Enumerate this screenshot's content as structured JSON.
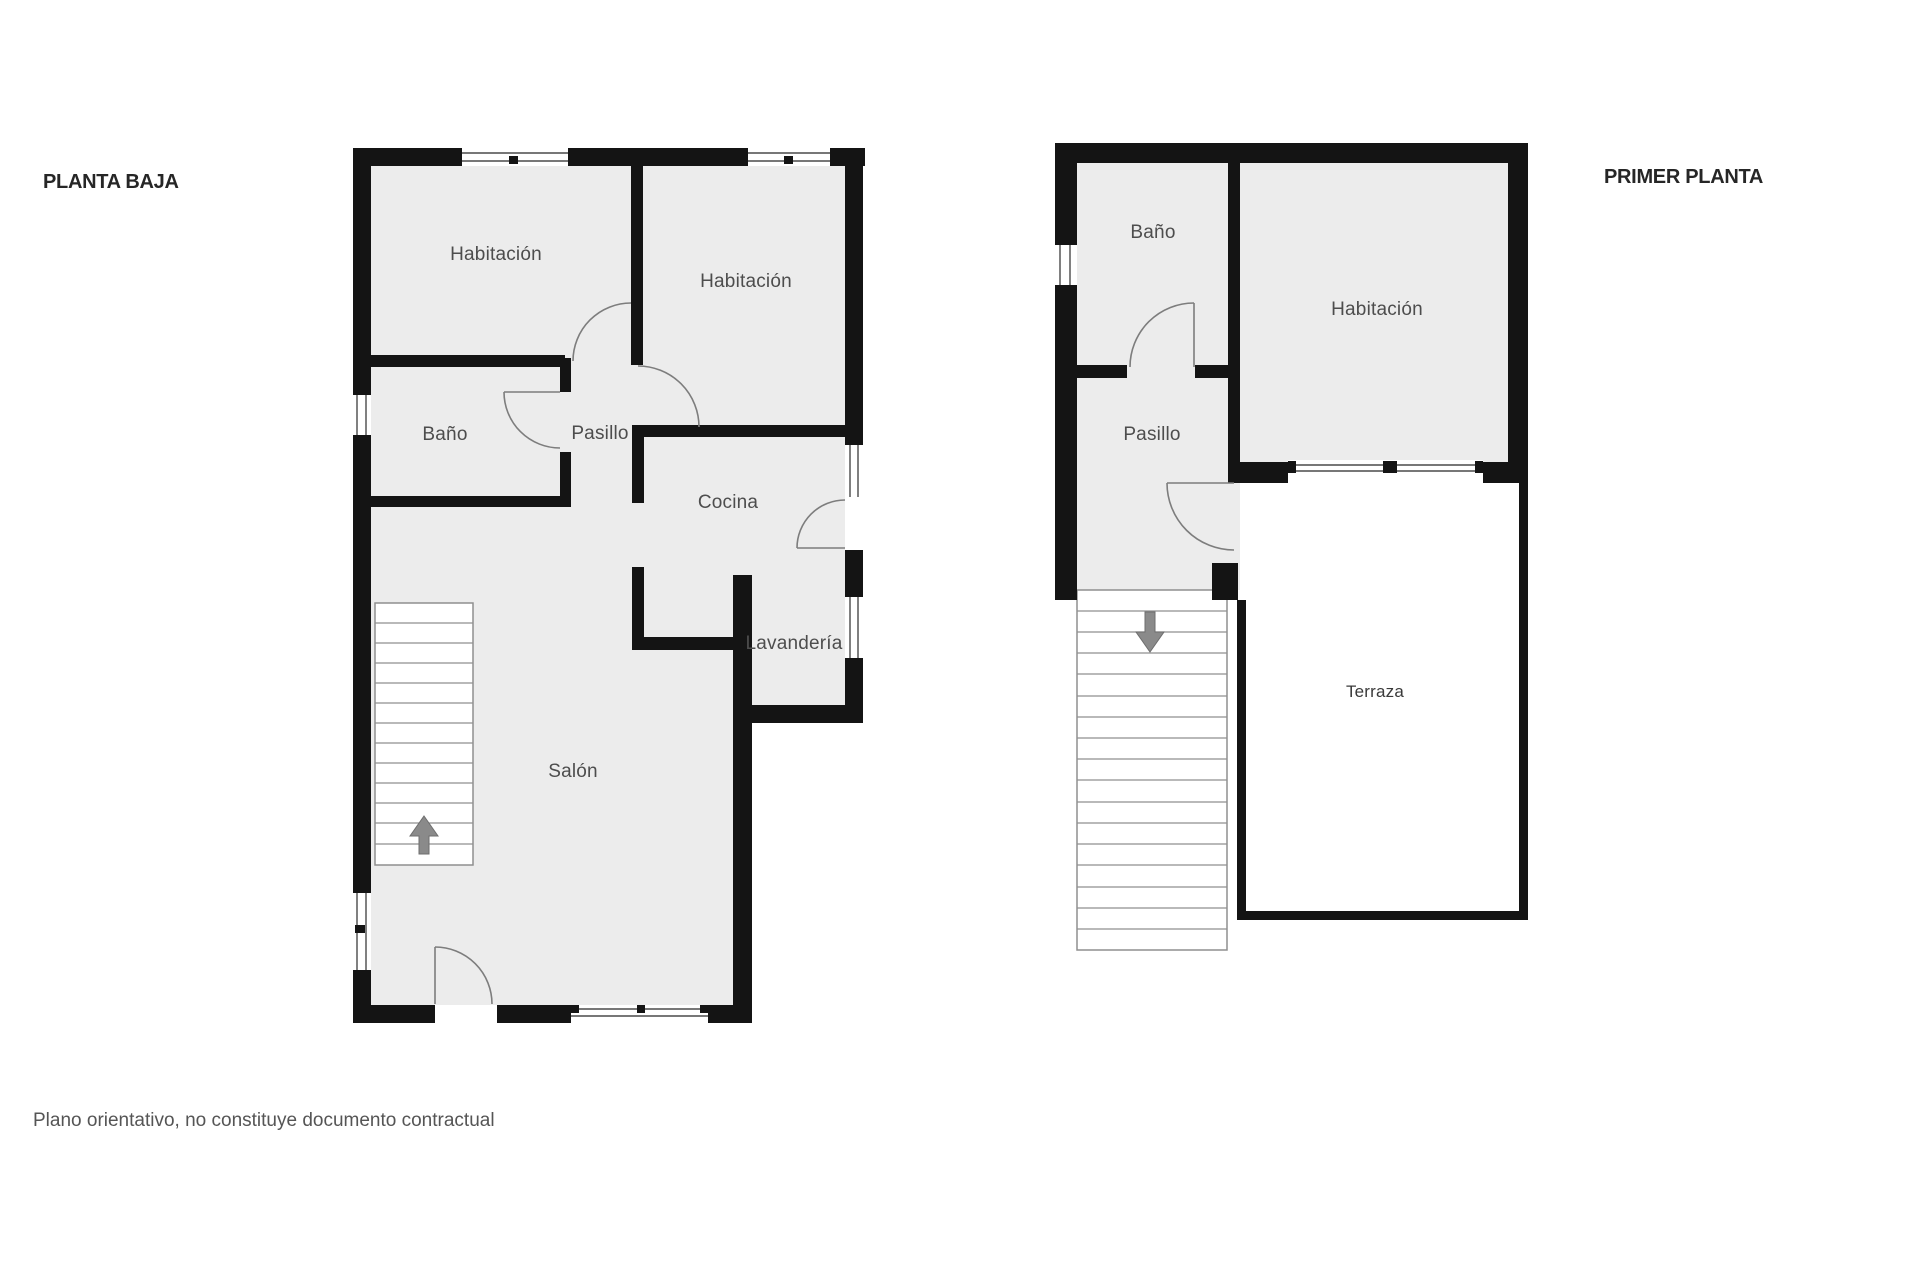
{
  "document": {
    "disclaimer": "Plano orientativo, no constituye documento contractual"
  },
  "floors": [
    {
      "id": "ground-floor",
      "title": "PLANTA BAJA",
      "rooms": [
        {
          "name": "Habitación"
        },
        {
          "name": "Habitación"
        },
        {
          "name": "Baño"
        },
        {
          "name": "Pasillo"
        },
        {
          "name": "Cocina"
        },
        {
          "name": "Lavandería"
        },
        {
          "name": "Salón"
        }
      ],
      "stairs": {
        "direction": "up",
        "steps": 13
      }
    },
    {
      "id": "first-floor",
      "title": "PRIMER PLANTA",
      "rooms": [
        {
          "name": "Baño"
        },
        {
          "name": "Habitación"
        },
        {
          "name": "Pasillo"
        },
        {
          "name": "Terraza"
        }
      ],
      "stairs": {
        "direction": "down",
        "steps": 17
      }
    }
  ],
  "colors": {
    "wall": "#141414",
    "room_fill": "#ececec",
    "door_arc": "#7d7d7d",
    "window_line": "#4a4a4a",
    "stair_line": "#8f8f8f",
    "arrow": "#8a8a8a",
    "label": "#4d4d4d",
    "title": "#262626",
    "disclaimer": "#555555"
  }
}
